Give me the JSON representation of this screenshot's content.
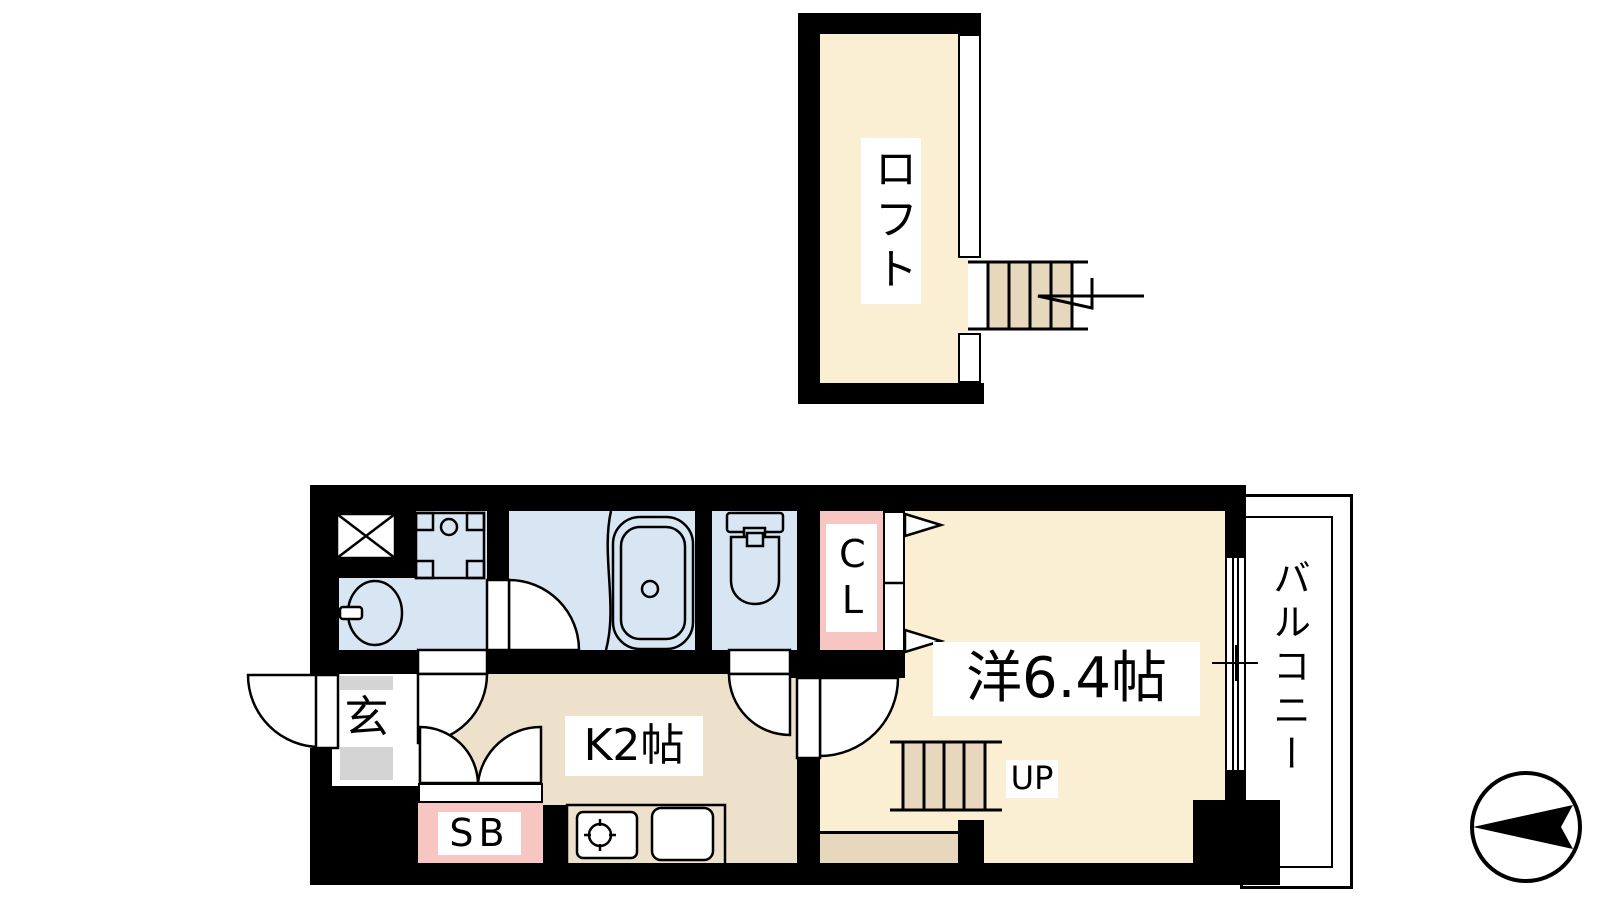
{
  "plan": {
    "type": "apartment-floor-plan",
    "loft": {
      "label": "ロフト"
    },
    "western_room": {
      "label": "洋6.4帖"
    },
    "kitchen": {
      "label": "K2帖"
    },
    "entrance": {
      "label": "玄"
    },
    "closet": {
      "label": "CL"
    },
    "shoe_box": {
      "label": "SB"
    },
    "stairs_up": {
      "label": "UP"
    },
    "balcony": {
      "label": "バルコニー"
    }
  },
  "fixtures": [
    "bathtub",
    "toilet",
    "wash-basin",
    "washing-machine-pan",
    "pipe-shaft",
    "stove",
    "kitchen-sink",
    "loft-stairs",
    "up-stairs",
    "sliding-window",
    "folding-closet-door",
    "entry-door",
    "north-arrow"
  ],
  "colors": {
    "wall": "#000000",
    "room_cream": "#FAEFD2",
    "kitchen_tan": "#EDE1CB",
    "step_beige": "#E7D8BD",
    "wet_area_blue": "#D8E6F4",
    "closet_pink": "#F7C6C3",
    "entrance_gray": "#D4D4D4",
    "line": "#000000",
    "background": "#FFFFFF"
  }
}
